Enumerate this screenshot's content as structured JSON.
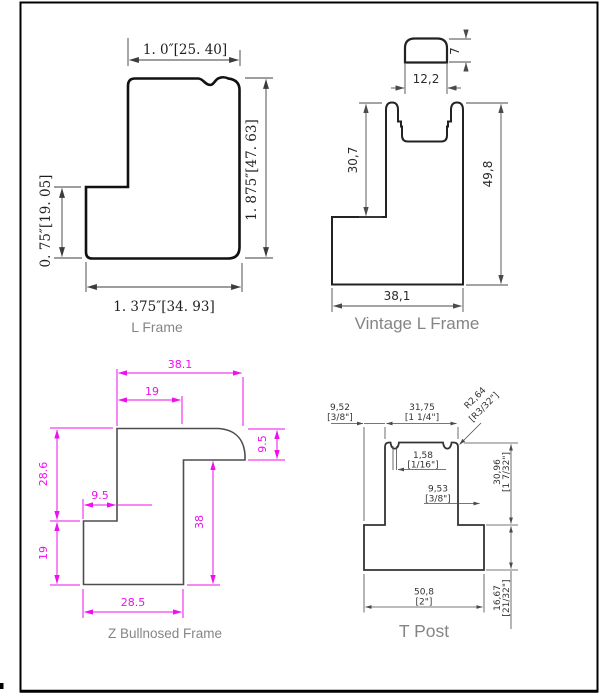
{
  "page": {
    "background": "#ffffff",
    "border_color": "#000000"
  },
  "l_frame": {
    "label": "L Frame",
    "dim_top": "1. 0″[25. 40]",
    "dim_right": "1. 875″[47. 63]",
    "dim_left": "0. 75″[19. 05]",
    "dim_bottom": "1. 375″[34. 93]",
    "line_color": "#3c3c3c",
    "text_color": "#1f1f1f"
  },
  "vintage_l_frame": {
    "label": "Vintage L Frame",
    "dim_cap_height": "7",
    "dim_cap_width": "12,2",
    "dim_upper_height": "30,7",
    "dim_overall_height": "49,8",
    "dim_bottom_width": "38,1",
    "line_color": "#4a4a4a"
  },
  "z_bullnosed_frame": {
    "label": "Z Bullnosed Frame",
    "dim_overall_width": "38.1",
    "dim_flange_width": "19",
    "dim_upper_height": "28.6",
    "dim_lower_height": "19",
    "dim_step_width": "9.5",
    "dim_bullnose_height": "9.5",
    "dim_web_height": "38",
    "dim_bottom_width": "28.5",
    "accent_color": "#ef0fef"
  },
  "t_post": {
    "label": "T Post",
    "dim_left_offset_mm": "9,52",
    "dim_left_offset_in": "[3/8\"]",
    "dim_stem_width_mm": "31,75",
    "dim_stem_width_in": "[1 1/4\"]",
    "dim_radius_mm": "R2,64",
    "dim_radius_in": "[R3/32\"]",
    "dim_groove_mm": "1,58",
    "dim_groove_in": "[1/16\"]",
    "dim_right_offset_mm": "9,53",
    "dim_right_offset_in": "[3/8\"]",
    "dim_stem_height_mm": "30,96",
    "dim_stem_height_in": "[1 7/32\"]",
    "dim_base_height_mm": "16,67",
    "dim_base_height_in": "[21/32\"]",
    "dim_base_width_mm": "50,8",
    "dim_base_width_in": "[2\"]",
    "line_color": "#4a4a4a"
  },
  "labels_color": "#858585"
}
